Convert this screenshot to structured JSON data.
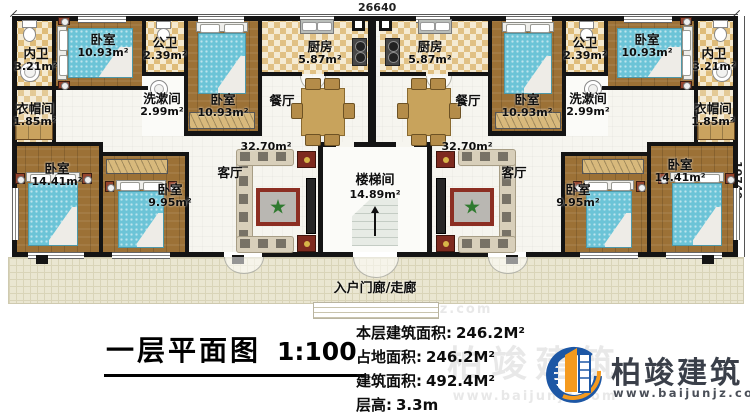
{
  "plan": {
    "dimensions": {
      "width_mm": "26640",
      "height_mm": "10740"
    },
    "rooms": {
      "neiwei": {
        "name": "内卫",
        "area": "3.21m²"
      },
      "bedroom_1093": {
        "name": "卧室",
        "area": "10.93m²"
      },
      "gongwei": {
        "name": "公卫",
        "area": "2.39m²"
      },
      "xishujian": {
        "name": "洗漱间",
        "area": "2.99m²"
      },
      "yimaojian": {
        "name": "衣帽间",
        "area": "1.85m²"
      },
      "kitchen": {
        "name": "厨房",
        "area": "5.87m²"
      },
      "dining": {
        "name": "餐厅"
      },
      "living": {
        "name": "客厅",
        "area": "32.70m²"
      },
      "bedroom_1441": {
        "name": "卧室",
        "area": "14.41m²"
      },
      "bedroom_995": {
        "name": "卧室",
        "area": "9.95m²"
      },
      "stair": {
        "name": "楼梯间",
        "area": "14.89m²"
      },
      "porch": {
        "name": "入户门廊/走廊"
      }
    },
    "watermark": {
      "brand": "柏竣建筑",
      "site": "www.baijunjz.com"
    }
  },
  "footer": {
    "title": "一层平面图",
    "scale": "1:100",
    "stats": [
      {
        "label": "本层建筑面积:",
        "value": "246.2M²"
      },
      {
        "label": "占地面积:",
        "value": "246.2M²"
      },
      {
        "label": "建筑面积:",
        "value": "492.4M²"
      },
      {
        "label": "层高:",
        "value": "3.3m"
      }
    ],
    "logo": {
      "brand": "柏竣建筑",
      "site": "www.baijunjz.com"
    },
    "colors": {
      "logo_blue": "#1d57a5",
      "logo_orange": "#f59a1e"
    }
  }
}
